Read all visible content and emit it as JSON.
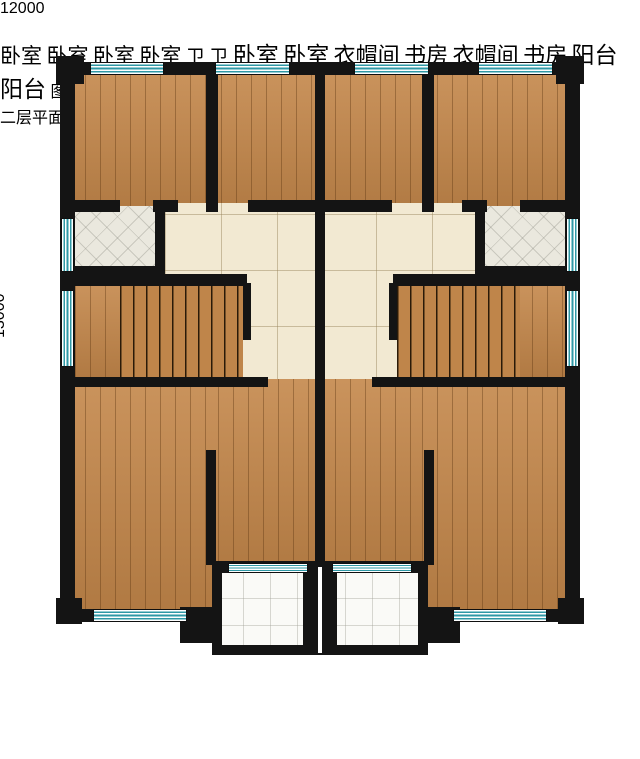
{
  "title": "二层平面图",
  "watermark_text": "图纸之家",
  "dimensions": {
    "top": "12000",
    "left": "13000"
  },
  "labels": {
    "bedroom": "卧室",
    "bathroom": "卫",
    "cloakroom": "衣帽间",
    "study": "书房",
    "balcony": "阳台"
  },
  "colors": {
    "wall": "#141414",
    "window_teal": "#2e98a6",
    "wood_floor": "#c4874a",
    "hall_tile": "#f2e9d2",
    "bathroom_tile": "#eae8de",
    "balcony_marble": "#fafaf7",
    "bed_dark": "#47565f",
    "bed_light": "#f1e9d2"
  }
}
